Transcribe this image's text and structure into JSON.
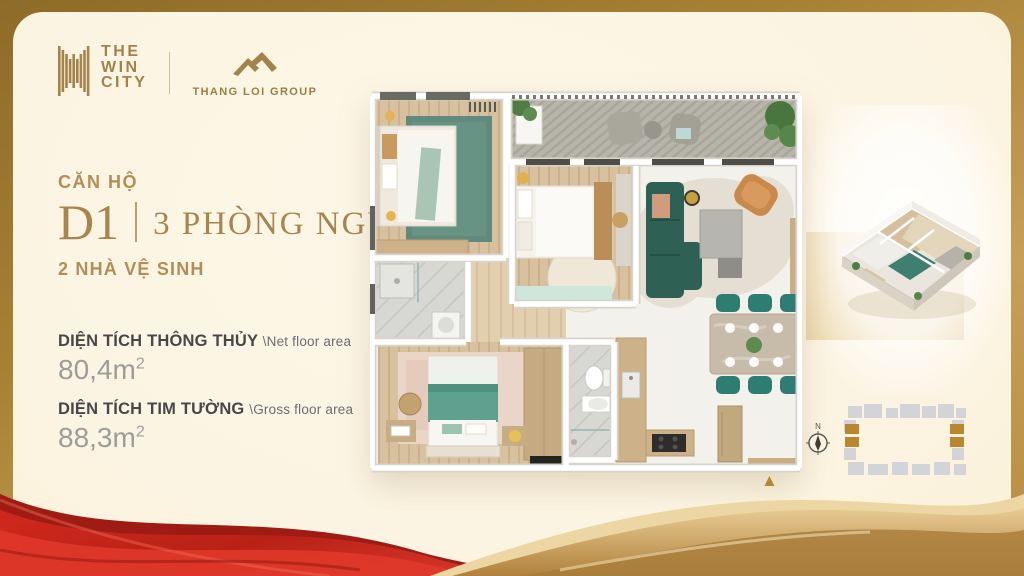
{
  "brand": {
    "the_win_city": {
      "lines": [
        "THE",
        "WIN",
        "CITY"
      ]
    },
    "thang_loi_group": {
      "label": "THANG LOI GROUP"
    }
  },
  "unit": {
    "category_label": "CĂN HỘ",
    "code": "D1",
    "bedrooms_label": "3 PHÒNG NGỦ",
    "bathrooms_label": "2 NHÀ VỆ SINH"
  },
  "areas": [
    {
      "label_vi": "DIỆN TÍCH THÔNG THỦY",
      "label_en": "\\Net floor area",
      "value": "80,4m",
      "sup": "2"
    },
    {
      "label_vi": "DIỆN TÍCH TIM TƯỜNG",
      "label_en": "\\Gross floor area",
      "value": "88,3m",
      "sup": "2"
    }
  ],
  "floor_plan": {
    "rooms": [
      "bedroom-1",
      "bedroom-2",
      "master-bedroom",
      "bathroom-1",
      "bathroom-2",
      "living-room",
      "kitchen",
      "dining-area",
      "balcony"
    ],
    "entrance_marker": "▲"
  },
  "minimap": {
    "compass_label": "N"
  },
  "colors": {
    "brand_gold": "#a3834c",
    "heading_gold": "#ab8852",
    "frame_gold": "#a68135",
    "card_cream": "#fdf6e5",
    "ribbon_red": "#c5251b",
    "wave_gold": "#c79e58",
    "accent_teal": "#2f7d72",
    "text_dark": "#474749",
    "text_muted": "#9c9c9a"
  }
}
